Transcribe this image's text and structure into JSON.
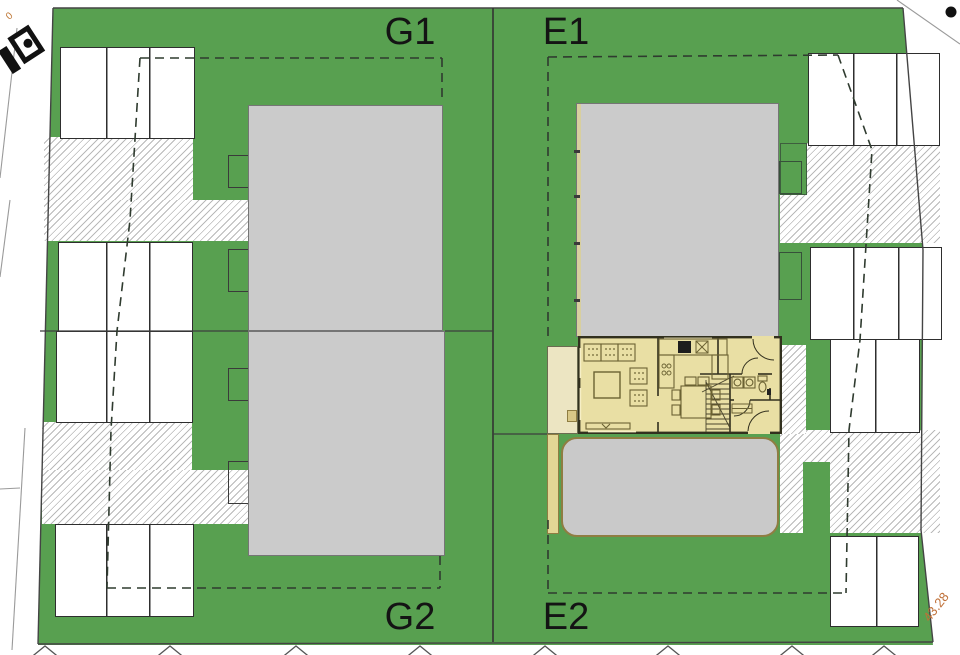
{
  "plot_labels": {
    "g1": "G1",
    "e1": "E1",
    "g2": "G2",
    "e2": "E2"
  },
  "annotations": {
    "boundary_dimension": "43.28",
    "road_label": "0"
  },
  "colors": {
    "grass_green": "#58a050",
    "building_gray": "#cbcbcb",
    "floorplan_fill": "#e9dfa4",
    "hatch_line": "#b9b9b9",
    "dimension_orange": "#bf7038"
  }
}
